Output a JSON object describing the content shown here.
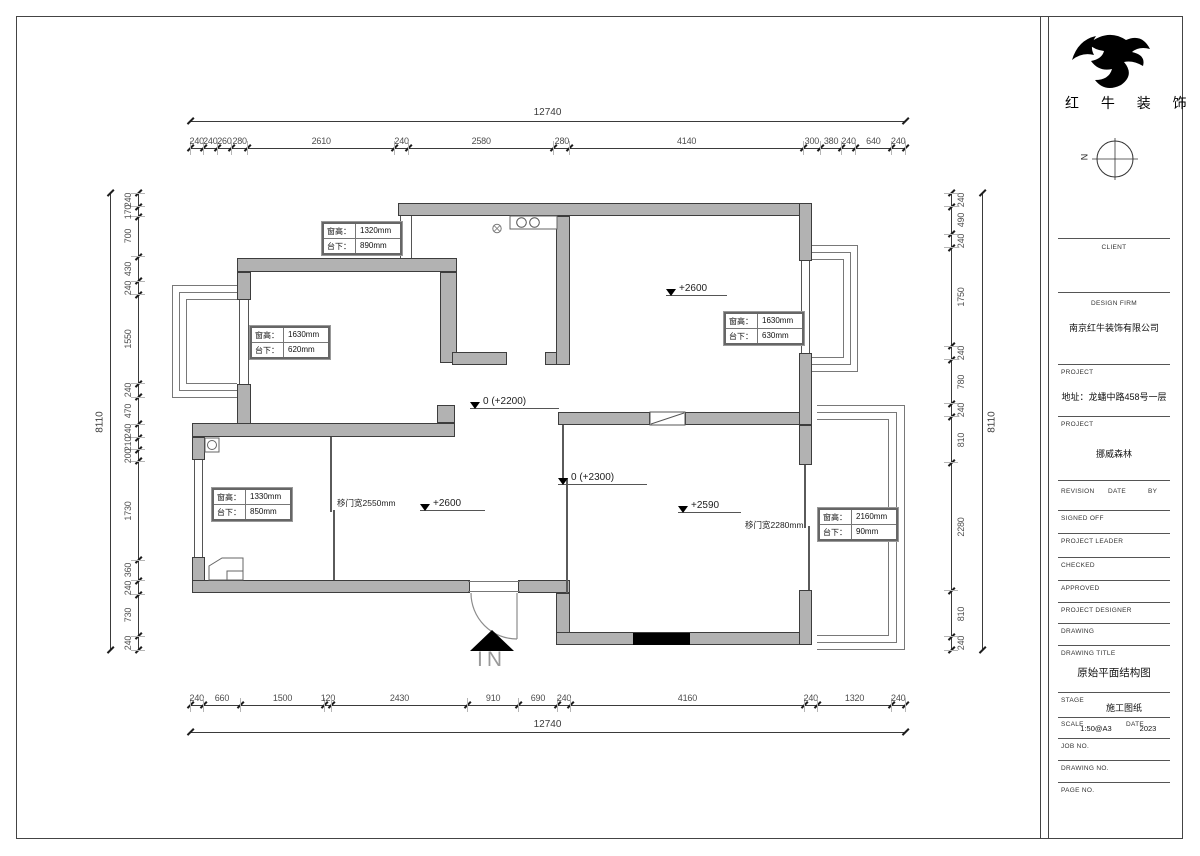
{
  "logo": {
    "brand_text": "红 牛 装 饰"
  },
  "north": {
    "label": "N"
  },
  "dimensions": {
    "top": {
      "total": "12740",
      "segments": [
        "240",
        "240",
        "260",
        "280",
        "2610",
        "240",
        "2580",
        "280",
        "4140",
        "300",
        "380",
        "240",
        "640",
        "240"
      ]
    },
    "bottom": {
      "total": "12740",
      "segments": [
        "240",
        "660",
        "1500",
        "120",
        "2430",
        "910",
        "690",
        "240",
        "4160",
        "240",
        "1320",
        "240"
      ]
    },
    "left": {
      "total": "8110",
      "segments": [
        "240",
        "170",
        "700",
        "430",
        "240",
        "1550",
        "240",
        "470",
        "240",
        "210",
        "200",
        "1730",
        "360",
        "240",
        "730",
        "240"
      ]
    },
    "right": {
      "total": "8110",
      "segments": [
        "240",
        "490",
        "240",
        "1750",
        "240",
        "780",
        "240",
        "810",
        "2280",
        "810",
        "240"
      ]
    }
  },
  "plan": {
    "wall_fill": "#b2b2b2",
    "walls": [
      [
        237,
        258,
        220,
        14
      ],
      [
        398,
        203,
        414,
        13
      ],
      [
        237,
        272,
        14,
        28
      ],
      [
        237,
        384,
        14,
        53
      ],
      [
        440,
        272,
        17,
        91
      ],
      [
        452,
        352,
        55,
        13
      ],
      [
        545,
        352,
        12,
        13
      ],
      [
        556,
        216,
        14,
        149
      ],
      [
        192,
        423,
        263,
        14
      ],
      [
        437,
        405,
        18,
        18
      ],
      [
        192,
        437,
        13,
        23
      ],
      [
        192,
        557,
        13,
        36
      ],
      [
        192,
        580,
        278,
        13
      ],
      [
        518,
        580,
        52,
        13
      ],
      [
        556,
        593,
        14,
        52
      ],
      [
        556,
        632,
        256,
        13
      ],
      [
        558,
        412,
        92,
        13
      ],
      [
        685,
        412,
        127,
        13
      ],
      [
        799,
        203,
        13,
        58
      ],
      [
        799,
        353,
        13,
        72
      ],
      [
        799,
        425,
        13,
        40
      ],
      [
        799,
        590,
        13,
        55
      ]
    ],
    "windows": [
      [
        400,
        216,
        12,
        42
      ],
      [
        239,
        300,
        10,
        84
      ],
      [
        194,
        460,
        9,
        97
      ],
      [
        801,
        261,
        9,
        92
      ]
    ],
    "bays": {
      "left": [
        [
          172,
          285,
          65,
          113
        ],
        [
          179,
          292,
          58,
          99
        ],
        [
          186,
          299,
          51,
          85
        ]
      ],
      "right": [
        [
          812,
          245,
          46,
          127
        ],
        [
          812,
          252,
          39,
          113
        ],
        [
          812,
          259,
          32,
          99
        ]
      ],
      "balcony": [
        [
          817,
          405,
          88,
          245
        ],
        [
          817,
          412,
          80,
          231
        ],
        [
          817,
          419,
          72,
          217
        ]
      ]
    },
    "sliders": [
      [
        330,
        437,
        75
      ],
      [
        333,
        510,
        70
      ],
      [
        562,
        425,
        55
      ],
      [
        566,
        478,
        115
      ],
      [
        804,
        465,
        63
      ],
      [
        808,
        526,
        64
      ]
    ],
    "black_block": [
      633,
      633,
      55,
      10
    ],
    "door_gap_lines": [
      [
        468,
        581,
        52
      ],
      [
        468,
        591,
        52
      ]
    ]
  },
  "annotations": {
    "levels": [
      {
        "text": "+2600",
        "x": 666,
        "y": 283,
        "w": 44
      },
      {
        "text": "0 (+2200)",
        "x": 470,
        "y": 396,
        "w": 72
      },
      {
        "text": "0 (+2300)",
        "x": 558,
        "y": 472,
        "w": 72
      },
      {
        "text": "+2600",
        "x": 420,
        "y": 498,
        "w": 48
      },
      {
        "text": "+2590",
        "x": 678,
        "y": 500,
        "w": 46
      }
    ],
    "door_labels": [
      {
        "text": "移门宽2550mm",
        "x": 337,
        "y": 497
      },
      {
        "text": "移门宽2280mm",
        "x": 745,
        "y": 519
      }
    ],
    "window_tags": [
      {
        "x": 322,
        "y": 222,
        "rows": [
          [
            "窗高：",
            "1320mm"
          ],
          [
            "台下：",
            "890mm"
          ]
        ]
      },
      {
        "x": 250,
        "y": 326,
        "rows": [
          [
            "窗高：",
            "1630mm"
          ],
          [
            "台下：",
            "620mm"
          ]
        ]
      },
      {
        "x": 724,
        "y": 312,
        "rows": [
          [
            "窗高：",
            "1630mm"
          ],
          [
            "台下：",
            "630mm"
          ]
        ]
      },
      {
        "x": 212,
        "y": 488,
        "rows": [
          [
            "窗高：",
            "1330mm"
          ],
          [
            "台下：",
            "850mm"
          ]
        ]
      },
      {
        "x": 818,
        "y": 508,
        "rows": [
          [
            "窗高：",
            "2160mm"
          ],
          [
            "台下：",
            "90mm"
          ]
        ]
      }
    ],
    "entrance_label": "IN"
  },
  "title_block": {
    "client_label": "CLIENT",
    "design_firm_label": "DESIGN FIRM",
    "design_firm": "南京红牛装饰有限公司",
    "project_label": "PROJECT",
    "address": "地址：龙蟠中路458号一层",
    "project_label2": "PROJECT",
    "project_name": "挪威森林",
    "revision_label": "REVISION",
    "date_label": "DATE",
    "by_label": "BY",
    "signed_off_label": "SIGNED OFF",
    "project_leader_label": "PROJECT LEADER",
    "checked_label": "CHECKED",
    "approved_label": "APPROVED",
    "project_designer_label": "PROJECT DESIGNER",
    "drawing_label": "DRAWING",
    "drawing_title_label": "DRAWING TITLE",
    "drawing_title": "原始平面结构图",
    "stage_label": "STAGE",
    "stage": "施工图纸",
    "scale_label": "SCALE",
    "scale": "1:50@A3",
    "date_label2": "DATE",
    "date": "2023",
    "job_no_label": "JOB NO.",
    "drawing_no_label": "DRAWING NO.",
    "page_no_label": "PAGE NO."
  }
}
